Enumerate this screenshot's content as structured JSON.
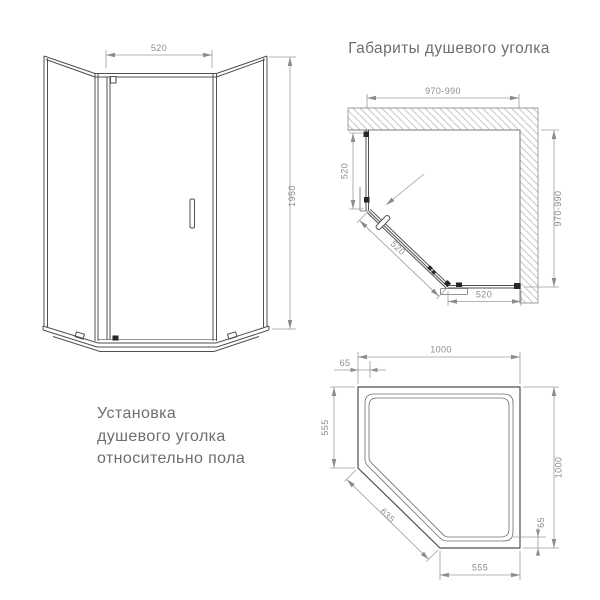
{
  "title": "Габариты душевого уголка",
  "caption": {
    "line1": "Установка",
    "line2": "душевого уголка",
    "line3": "относительно пола"
  },
  "front_view": {
    "dims": {
      "door_width_top": "520",
      "height_right": "1950"
    }
  },
  "plan_view": {
    "dims": {
      "top_width": "970-990",
      "left_panel": "520",
      "door_diagonal": "520",
      "bottom_panel": "520",
      "right_depth": "970-990"
    }
  },
  "tray_view": {
    "dims": {
      "top_width": "1000",
      "top_left_offset": "65",
      "left_side": "555",
      "diagonal_front": "635",
      "right_side": "1000",
      "bottom_right_offset": "65",
      "bottom_width": "555"
    }
  },
  "colors": {
    "drawing_line": "#4f4f4f",
    "dimension_line": "#9c9c9c",
    "dimension_text": "#8c8c8c",
    "heading_text": "#6e6e6e",
    "hatch_line": "#bdbdbd",
    "background": "#ffffff"
  }
}
